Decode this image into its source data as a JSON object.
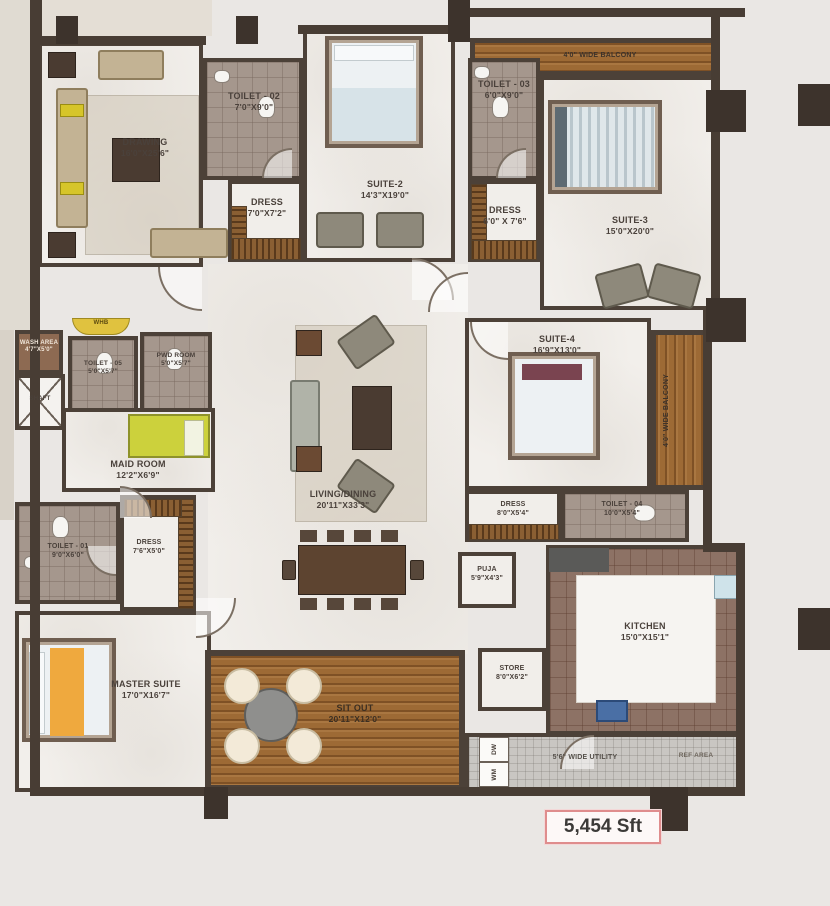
{
  "rooms": {
    "drawing": {
      "name": "DRAWING",
      "dims": "16'0\"X25'6\""
    },
    "toilet_02": {
      "name": "TOILET - 02",
      "dims": "7'0\"X9'0\""
    },
    "dress_2": {
      "name": "DRESS",
      "dims": "7'0\"X7'2\""
    },
    "suite_2": {
      "name": "SUITE-2",
      "dims": "14'3\"X19'0\""
    },
    "toilet_03": {
      "name": "TOILET - 03",
      "dims": "6'0\"X9'0\""
    },
    "dress_3": {
      "name": "DRESS",
      "dims": "6'0\" X 7'6\""
    },
    "suite_3": {
      "name": "SUITE-3",
      "dims": "15'0\"X20'0\""
    },
    "wash_area": {
      "name": "WASH AREA",
      "dims": "4'7\"X5'0\""
    },
    "shaft": {
      "name": "SHAFT"
    },
    "toilet_05": {
      "name": "TOILET - 05",
      "dims": "5'0\"X5'7\""
    },
    "pwd_room": {
      "name": "PWD ROOM",
      "dims": "5'0\"X5'7\""
    },
    "maid_room": {
      "name": "MAID ROOM",
      "dims": "12'2\"X6'9\""
    },
    "toilet_01": {
      "name": "TOILET - 01",
      "dims": "9'0\"X6'0\""
    },
    "dress_1": {
      "name": "DRESS",
      "dims": "7'6\"X5'0\""
    },
    "master_suite": {
      "name": "MASTER SUITE",
      "dims": "17'0\"X16'7\""
    },
    "living_dining": {
      "name": "LIVING/DINING",
      "dims": "20'11\"X33'3\""
    },
    "suite_4": {
      "name": "SUITE-4",
      "dims": "16'9\"X13'0\""
    },
    "dress_4": {
      "name": "DRESS",
      "dims": "8'0\"X5'4\""
    },
    "toilet_04": {
      "name": "TOILET - 04",
      "dims": "10'0\"X5'4\""
    },
    "puja": {
      "name": "PUJA",
      "dims": "5'9\"X4'3\""
    },
    "kitchen": {
      "name": "KITCHEN",
      "dims": "15'0\"X15'1\""
    },
    "store": {
      "name": "STORE",
      "dims": "8'0\"X6'2\""
    },
    "sit_out": {
      "name": "SIT OUT",
      "dims": "20'11\"X12'0\""
    },
    "balcony_top": {
      "name": "4'0\" WIDE BALCONY"
    },
    "balcony_right": {
      "name": "4'0\" WIDE BALCONY"
    },
    "utility": {
      "name": "5'6\" WIDE UTILITY"
    },
    "ref_area": {
      "name": "REF AREA"
    },
    "whb": {
      "name": "WHB"
    }
  },
  "appliances": {
    "wm": "WM",
    "dw": "DW"
  },
  "summary": {
    "total_area": "5,454 Sft"
  },
  "colors": {
    "wall": "#483d34",
    "wood": "#9d6a35",
    "area_box_border": "#df8d8d",
    "maid_bed": "#ccd13c",
    "master_blanket": "#efa93e"
  }
}
